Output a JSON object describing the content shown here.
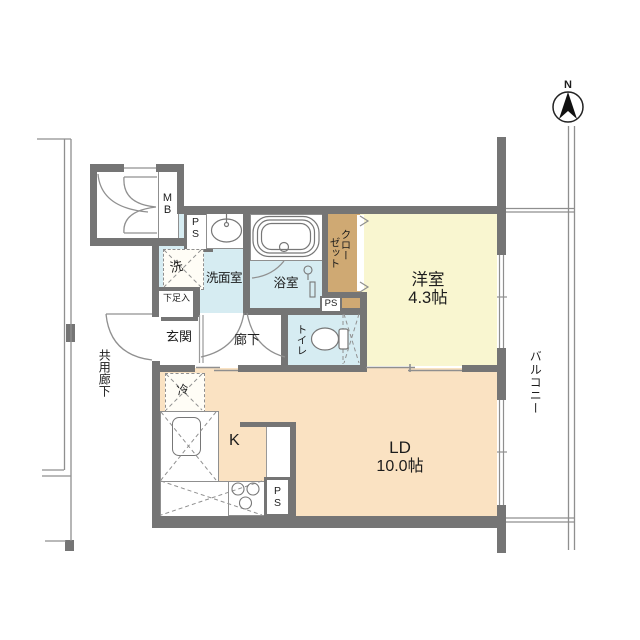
{
  "floorplan": {
    "compass": {
      "north_label": "N"
    },
    "rooms": {
      "western_room": {
        "name": "洋室",
        "size": "4.3帖"
      },
      "living_dining": {
        "name": "LD",
        "size": "10.0帖"
      },
      "kitchen": {
        "name": "K"
      },
      "entrance": {
        "name": "玄関"
      },
      "hallway": {
        "name": "廊下"
      },
      "toilet": {
        "name": "トイレ"
      },
      "bathroom": {
        "name": "浴室"
      },
      "washroom": {
        "name": "洗面室"
      },
      "closet": {
        "name": "クローゼット",
        "col1": "クロー",
        "col2": "ゼット"
      },
      "shoe_cabinet": {
        "name": "下足入"
      },
      "balcony": {
        "name": "バルコニー"
      },
      "common_corridor": {
        "name": "共用廊下"
      }
    },
    "equipment": {
      "meter_box": "MB",
      "pipe_space": "PS",
      "washer": "洗",
      "refrigerator": "冷"
    },
    "colors": {
      "wall": "#757575",
      "wet_area": "#d6ecf2",
      "western_room": "#f9f6d0",
      "living_dining": "#fae2c2",
      "closet": "#cfa973"
    }
  }
}
